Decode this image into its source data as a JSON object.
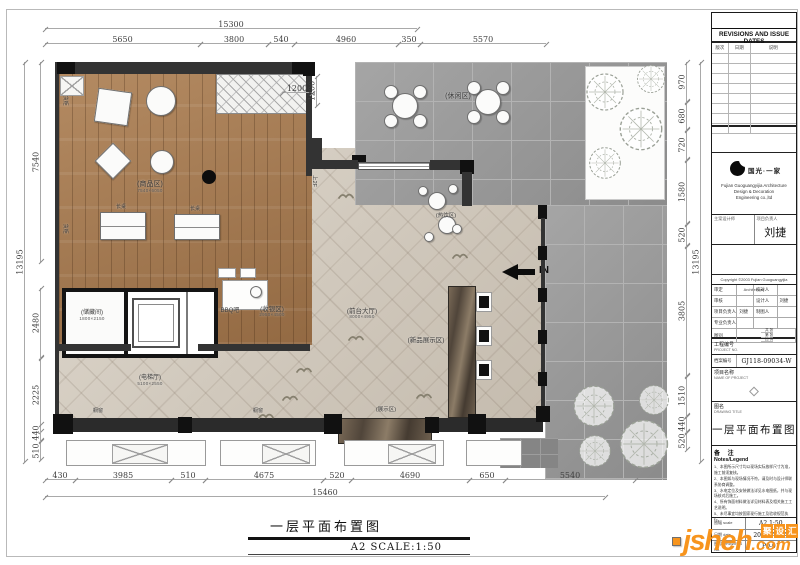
{
  "main_title": {
    "text": "一层平面布置图",
    "scale": "A2 SCALE:1:50"
  },
  "watermark": {
    "site": "jsheh",
    "domain": ".com",
    "zh": [
      "聚",
      "设",
      "汇"
    ],
    "color": "#f7941d"
  },
  "title_block": {
    "revisions_header": "REVISIONS AND ISSUE DATES",
    "rev_cols": [
      "版次",
      "日期",
      "说明"
    ],
    "rev_empty_rows": 8,
    "company_zh": "国光·一家",
    "company_en": [
      "Fujian Guoguangyijia Architecture",
      "Design & Decoration",
      "Engineering co.,ltd"
    ],
    "designer_label": "主案设计师",
    "pm_label": "项目负责人",
    "pm_name": "刘捷",
    "copyright": "Copyright ©2003 Fujian Guoguangyijia Architecture",
    "approval_rows": [
      [
        "审定",
        "",
        "校对人",
        ""
      ],
      [
        "审核",
        "",
        "设计人",
        "刘捷"
      ],
      [
        "项目负责人",
        "刘捷",
        "制图人",
        ""
      ],
      [
        "专业负责人",
        "",
        "",
        ""
      ]
    ],
    "sheet_class_label": "图别",
    "sheet_class_minis": [
      "共  张",
      "第  张",
      "比  例"
    ],
    "project_no_label": "工程编号",
    "project_no_en": "PROJECT NO.",
    "archive_label": "档案编号",
    "archive_no": "GJ118-09034-W",
    "project_name_label": "项目名称",
    "project_name_en": "NAME OF PROJECT",
    "drawing_title_label": "图名",
    "drawing_title_en": "DRAWING TITLE",
    "drawing_title": "一层平面布置图",
    "notes_label": "备 注",
    "notes_en": "Notes/Legend",
    "notes": [
      "1、本图所示尺寸均以现场实际放样尺寸为准，施工前须复核。",
      "2、本图如与现场情况不符，请及时与设计师联系协商调整。",
      "3、水电定位及安装做法详见水电图纸，并与现场核对后施工。",
      "4、所有饰面材料做法详见材料表及相关施工工艺说明。",
      "5、未尽事宜均按国家现行施工及验收规范执行。"
    ],
    "bottom_rows": [
      [
        "图幅 scale",
        "A2 1:50"
      ],
      [
        "日期 date",
        "2018年11月"
      ],
      [
        "图号 DRAWING No.",
        "P0-01"
      ]
    ]
  },
  "plan": {
    "in_label": "IN",
    "labels": [
      {
        "t": "(休闲区)",
        "x": 458,
        "y": 93,
        "s": 7,
        "sub": "",
        "rot": 0
      },
      {
        "t": "(商品区)",
        "x": 150,
        "y": 181,
        "s": 7,
        "sub": "7540×6050",
        "rot": 0
      },
      {
        "t": "BBQ吧",
        "x": 230,
        "y": 308,
        "s": 6,
        "sub": "",
        "rot": 0
      },
      {
        "t": "(收银区)",
        "x": 272,
        "y": 306,
        "s": 6.5,
        "sub": "2950×4500",
        "rot": 0
      },
      {
        "t": "(前台大厅)",
        "x": 362,
        "y": 308,
        "s": 6.5,
        "sub": "8000×4950",
        "rot": 0
      },
      {
        "t": "(新品展示区)",
        "x": 426,
        "y": 337,
        "s": 6.5,
        "sub": "",
        "rot": 0
      },
      {
        "t": "(储藏间)",
        "x": 92,
        "y": 310,
        "s": 6,
        "sub": "1800×2150",
        "rot": 0
      },
      {
        "t": "(电梯厅)",
        "x": 150,
        "y": 375,
        "s": 6,
        "sub": "5100×2550",
        "rot": 0
      },
      {
        "t": "(热饮区)",
        "x": 446,
        "y": 213,
        "s": 5.5,
        "sub": "",
        "rot": 0
      },
      {
        "t": "(展示区)",
        "x": 386,
        "y": 407,
        "s": 5.5,
        "sub": "",
        "rot": 0
      },
      {
        "t": "橱窗",
        "x": 98,
        "y": 409,
        "s": 5,
        "sub": "",
        "rot": 0
      },
      {
        "t": "橱窗",
        "x": 258,
        "y": 409,
        "s": 5,
        "sub": "",
        "rot": 0
      },
      {
        "t": "长桌",
        "x": 121,
        "y": 205,
        "s": 5,
        "sub": "",
        "rot": 0
      },
      {
        "t": "长桌",
        "x": 195,
        "y": 207,
        "s": 5,
        "sub": "",
        "rot": 0
      },
      {
        "t": "货柜",
        "x": 64,
        "y": 98,
        "s": 5,
        "sub": "",
        "rot": 90
      },
      {
        "t": "货柜",
        "x": 64,
        "y": 226,
        "s": 5,
        "sub": "",
        "rot": 90
      },
      {
        "t": "上2F",
        "x": 314,
        "y": 178,
        "s": 5.5,
        "sub": "",
        "rot": 90
      }
    ],
    "dims_h": [
      [
        "15300",
        45,
        28,
        372
      ],
      [
        "5650",
        45,
        43,
        155
      ],
      [
        "3800",
        200,
        43,
        68
      ],
      [
        "540",
        268,
        43,
        26
      ],
      [
        "4960",
        294,
        43,
        104
      ],
      [
        "350",
        398,
        43,
        22
      ],
      [
        "5570",
        420,
        43,
        126
      ],
      [
        "1200",
        282,
        92,
        30
      ],
      [
        "430",
        45,
        479,
        30
      ],
      [
        "3985",
        75,
        479,
        96
      ],
      [
        "510",
        171,
        479,
        34
      ],
      [
        "4675",
        205,
        479,
        118
      ],
      [
        "520",
        323,
        479,
        28
      ],
      [
        "4690",
        351,
        479,
        118
      ],
      [
        "650",
        469,
        479,
        36
      ],
      [
        "5540",
        505,
        479,
        130
      ],
      [
        "15460",
        45,
        496,
        560
      ]
    ],
    "dims_v": [
      [
        "13195",
        24,
        62,
        400
      ],
      [
        "7540",
        40,
        62,
        200
      ],
      [
        "2480",
        40,
        288,
        70
      ],
      [
        "2225",
        40,
        358,
        74
      ],
      [
        "440",
        40,
        424,
        17
      ],
      [
        "510",
        40,
        441,
        19
      ],
      [
        "970",
        686,
        62,
        40
      ],
      [
        "680",
        686,
        102,
        28
      ],
      [
        "720",
        686,
        130,
        30
      ],
      [
        "1580",
        686,
        160,
        64
      ],
      [
        "520",
        686,
        224,
        22
      ],
      [
        "3805",
        686,
        246,
        130
      ],
      [
        "1510",
        686,
        376,
        40
      ],
      [
        "440",
        686,
        416,
        16
      ],
      [
        "520",
        686,
        432,
        18
      ],
      [
        "13195",
        700,
        62,
        400
      ],
      [
        "1200",
        316,
        76,
        30
      ]
    ],
    "shapes": [
      [
        "wall",
        55,
        62,
        4,
        362
      ],
      [
        "wall",
        57,
        62,
        253,
        12
      ],
      [
        "col",
        57,
        62,
        18,
        12
      ],
      [
        "col",
        292,
        62,
        18,
        12
      ],
      [
        "col",
        303,
        62,
        12,
        14
      ],
      [
        "wall",
        306,
        76,
        6,
        100
      ],
      [
        "xb",
        60,
        76,
        24,
        20
      ],
      [
        "wall",
        312,
        138,
        10,
        26
      ],
      [
        "col",
        352,
        155,
        14,
        13
      ],
      [
        "wall",
        312,
        160,
        46,
        9
      ],
      [
        "win",
        358,
        162,
        72,
        8
      ],
      [
        "wall",
        430,
        160,
        34,
        10
      ],
      [
        "col",
        460,
        160,
        14,
        14
      ],
      [
        "wall",
        462,
        172,
        10,
        34
      ],
      [
        "col",
        538,
        205,
        9,
        14
      ],
      [
        "wall",
        541,
        218,
        4,
        195
      ],
      [
        "col",
        538,
        246,
        9,
        14
      ],
      [
        "col",
        538,
        288,
        9,
        14
      ],
      [
        "col",
        538,
        330,
        9,
        14
      ],
      [
        "col",
        538,
        372,
        9,
        14
      ],
      [
        "col",
        536,
        406,
        14,
        16
      ],
      [
        "wall",
        57,
        344,
        74,
        7
      ],
      [
        "wall",
        198,
        344,
        112,
        7
      ],
      [
        "mar",
        448,
        286,
        28,
        132
      ],
      [
        "wb",
        476,
        292,
        16,
        20
      ],
      [
        "col",
        479,
        296,
        10,
        12
      ],
      [
        "wb",
        476,
        326,
        16,
        20
      ],
      [
        "col",
        479,
        330,
        10,
        12
      ],
      [
        "wb",
        476,
        360,
        16,
        20
      ],
      [
        "col",
        479,
        364,
        10,
        12
      ],
      [
        "mar",
        338,
        418,
        94,
        26
      ],
      [
        "col",
        53,
        414,
        20,
        20
      ],
      [
        "col",
        178,
        417,
        14,
        16
      ],
      [
        "col",
        324,
        414,
        18,
        20
      ],
      [
        "col",
        425,
        417,
        14,
        16
      ],
      [
        "col",
        468,
        414,
        18,
        20
      ],
      [
        "wb",
        66,
        440,
        140,
        26
      ],
      [
        "xb",
        112,
        444,
        56,
        20
      ],
      [
        "wb",
        220,
        440,
        96,
        26
      ],
      [
        "xb",
        262,
        444,
        48,
        20
      ],
      [
        "wb",
        344,
        440,
        100,
        26
      ],
      [
        "xb",
        388,
        444,
        48,
        20
      ],
      [
        "wb",
        466,
        440,
        56,
        26
      ],
      [
        "sq",
        96,
        90,
        34,
        34,
        8
      ],
      [
        "ci",
        146,
        86,
        30,
        30
      ],
      [
        "sq",
        100,
        148,
        26,
        26,
        45
      ],
      [
        "ci",
        150,
        150,
        24,
        24
      ],
      [
        "dot",
        202,
        170,
        14,
        14
      ],
      [
        "lt",
        100,
        212,
        46,
        28
      ],
      [
        "lt",
        174,
        214,
        46,
        26
      ],
      [
        "wb",
        222,
        280,
        46,
        30
      ],
      [
        "ci",
        250,
        286,
        12,
        12
      ],
      [
        "wb",
        218,
        268,
        18,
        10
      ],
      [
        "wb",
        240,
        268,
        16,
        10
      ],
      [
        "ci",
        428,
        192,
        18,
        18
      ],
      [
        "ci",
        438,
        216,
        18,
        18
      ],
      [
        "ci",
        418,
        186,
        10,
        10
      ],
      [
        "ci",
        448,
        184,
        10,
        10
      ],
      [
        "ci",
        424,
        232,
        10,
        10
      ],
      [
        "ci",
        452,
        224,
        10,
        10
      ],
      [
        "tc",
        405,
        106,
        0,
        0
      ],
      [
        "tc",
        488,
        102,
        0,
        0
      ],
      [
        "tree",
        585,
        72,
        40,
        40
      ],
      [
        "tree",
        618,
        106,
        46,
        46
      ],
      [
        "tree",
        588,
        146,
        34,
        34
      ],
      [
        "tree",
        636,
        64,
        30,
        30
      ],
      [
        "tree",
        572,
        384,
        44,
        44
      ],
      [
        "tree",
        618,
        418,
        52,
        52
      ],
      [
        "tree",
        578,
        434,
        34,
        34
      ],
      [
        "tree",
        638,
        384,
        32,
        32
      ],
      [
        "bird",
        338,
        188,
        16,
        10
      ],
      [
        "bird",
        452,
        248,
        16,
        10
      ],
      [
        "bird",
        296,
        362,
        16,
        10
      ],
      [
        "bird",
        282,
        390,
        16,
        10
      ],
      [
        "bird",
        416,
        388,
        16,
        10
      ],
      [
        "bird",
        258,
        408,
        16,
        10
      ],
      [
        "bird",
        348,
        330,
        16,
        10
      ]
    ]
  }
}
